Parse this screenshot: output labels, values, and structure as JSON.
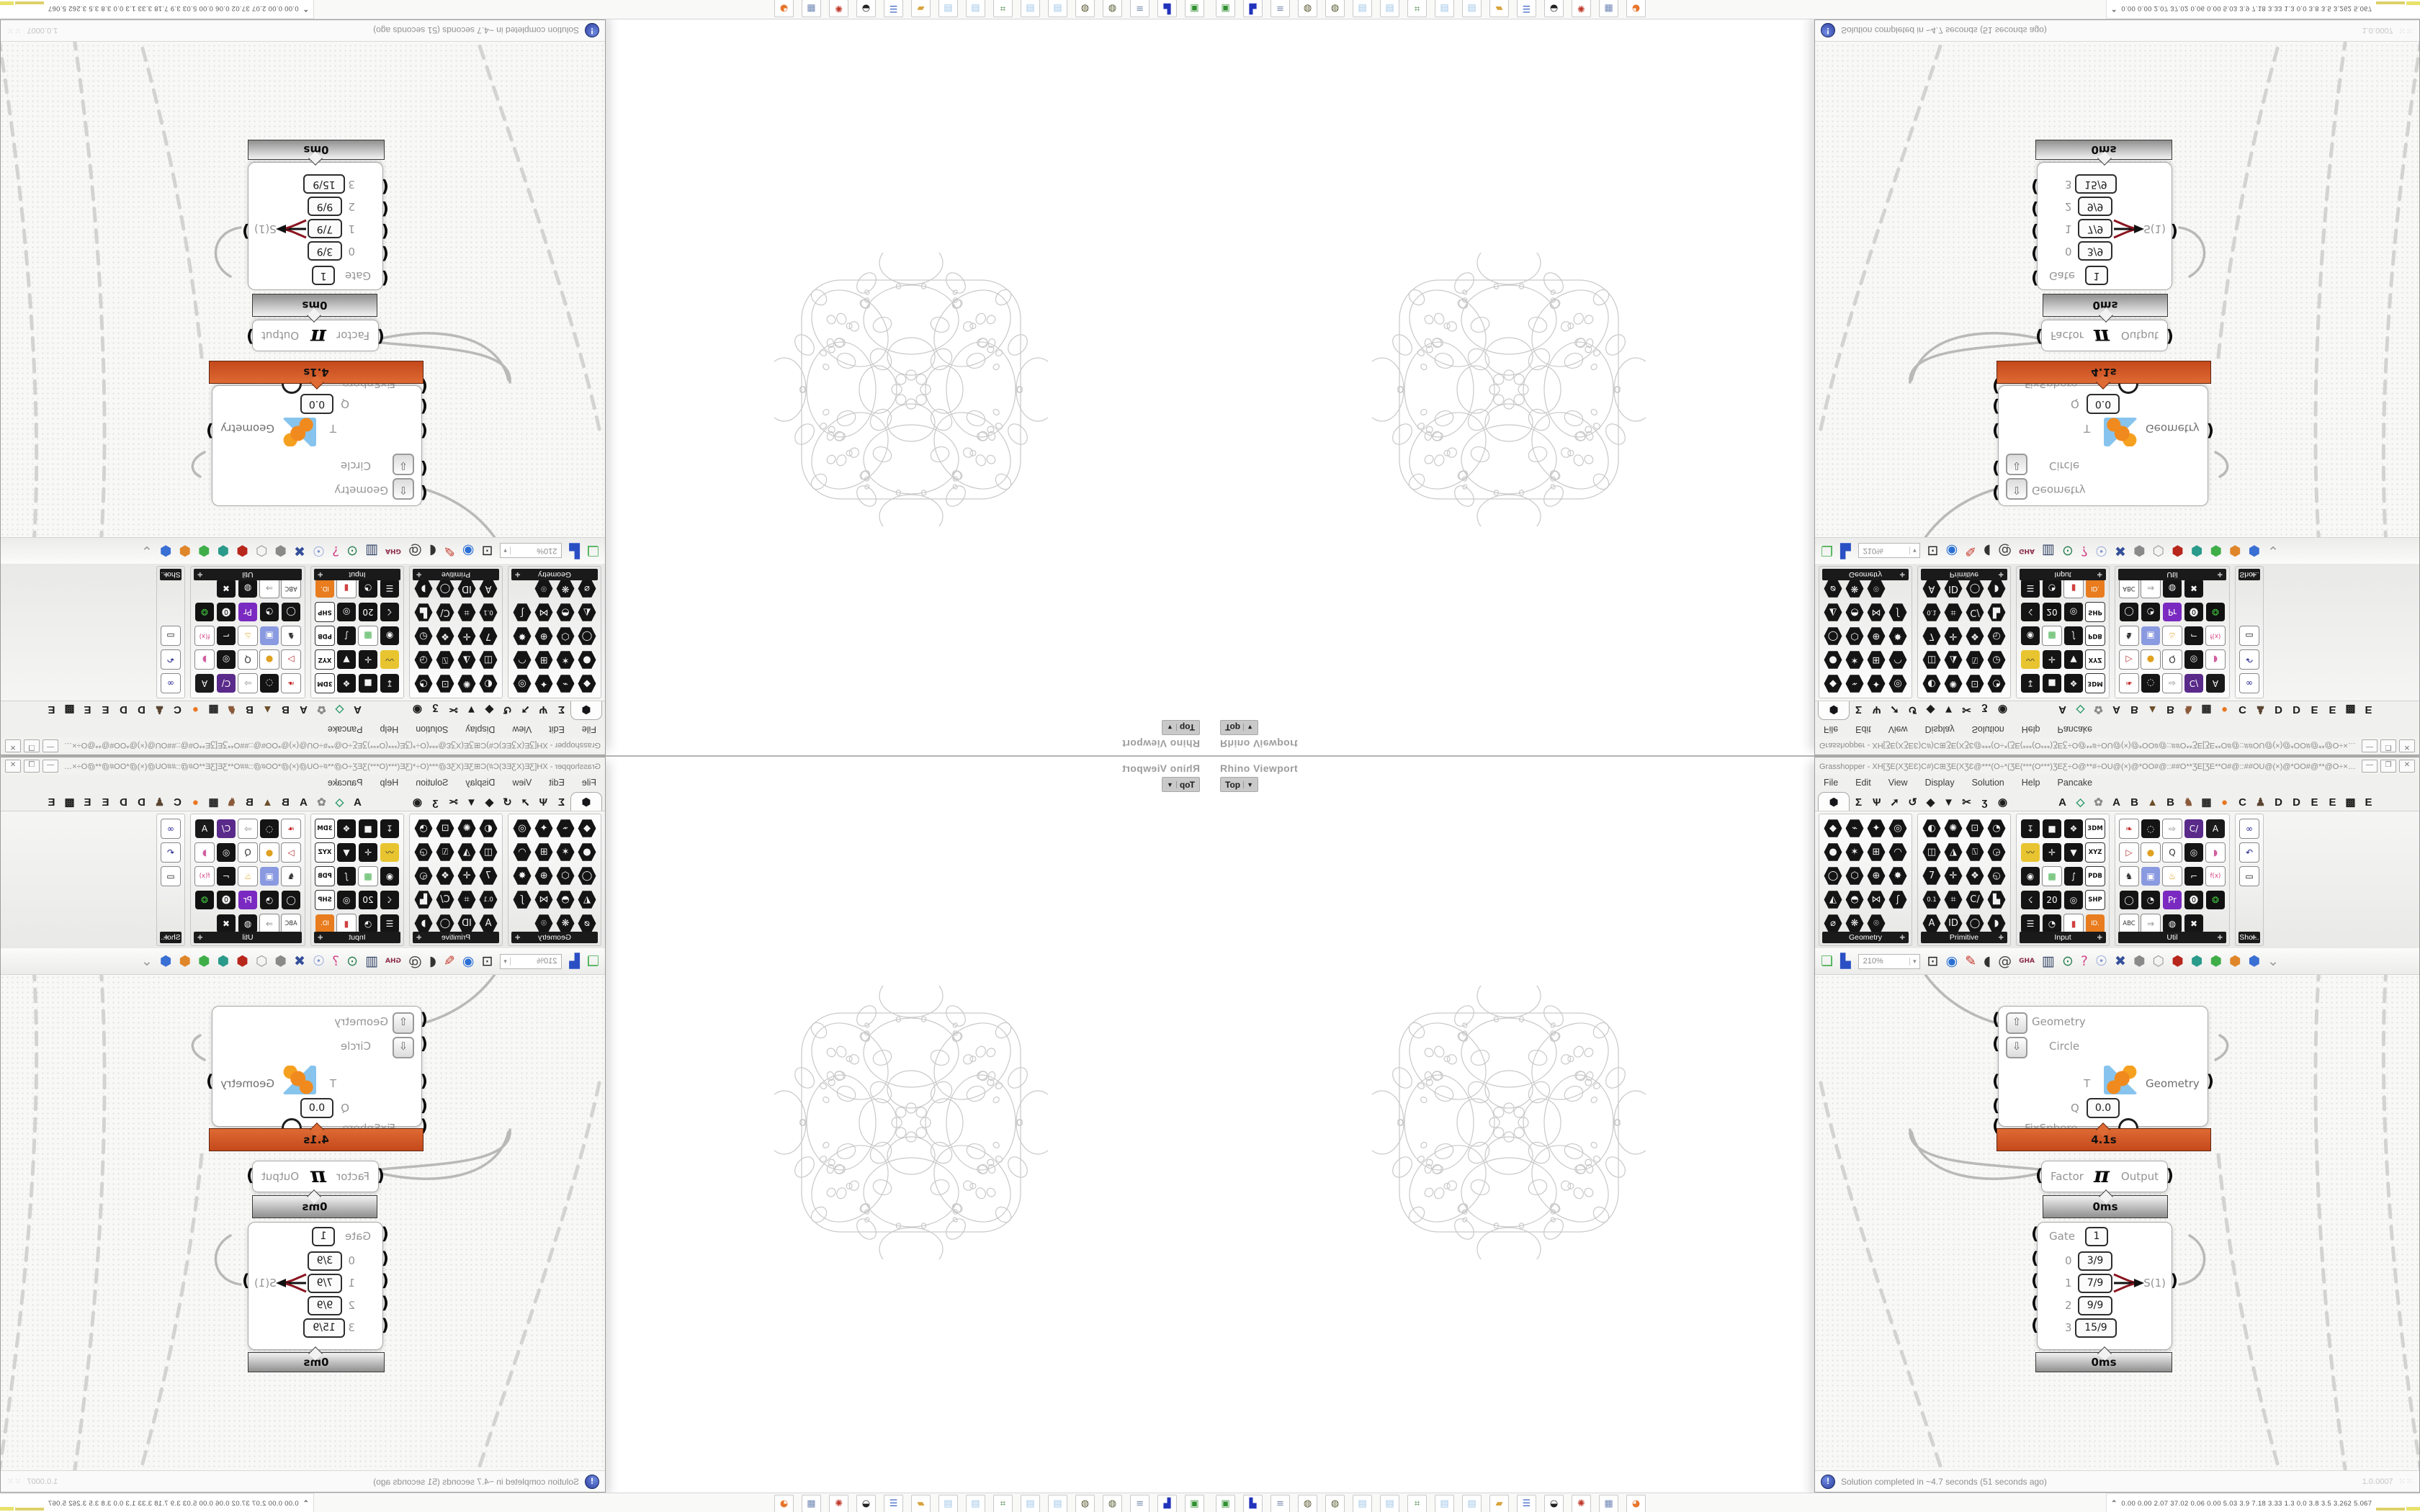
{
  "window": {
    "title": "Grasshopper - XH[ƷE(XƷEƐ)C#)C⊞ƷE(XƷƐ@***(O÷*(ƷE(***(O***)ƷEƸ÷O@**#÷OU@(×)@*OO#@::##O**ƷE[ƷE**O#@::##OU@(×)@*OO#@**@O÷×ƷƐ(**O**...",
    "buttons": [
      {
        "name": "minimize-button",
        "glyph": "—"
      },
      {
        "name": "maximize-button",
        "glyph": "❐"
      },
      {
        "name": "close-button",
        "glyph": "✕"
      }
    ]
  },
  "menu": {
    "items": [
      "File",
      "Edit",
      "View",
      "Display",
      "Solution",
      "Help",
      "Pancake"
    ]
  },
  "tabs": {
    "selected_glyph": "⬢",
    "main": [
      "Σ",
      "Ѱ",
      "➚",
      "↺",
      "◆",
      "▼",
      "✂",
      "ʒ",
      "◉"
    ],
    "plugins": [
      [
        "A",
        "#1d1d1d"
      ],
      [
        "◇",
        "#2a9a6a"
      ],
      [
        "✿",
        "#8a8a8a"
      ],
      [
        "A",
        "#1d1d1d"
      ],
      [
        "B",
        "#1d1d1d"
      ],
      [
        "▲",
        "#6b4f2a"
      ],
      [
        "B",
        "#1d1d1d"
      ],
      [
        "♞",
        "#8a5a3a"
      ],
      [
        "▦",
        "#1d1d1d"
      ],
      [
        "●",
        "#e87722"
      ],
      [
        "C",
        "#1d1d1d"
      ],
      [
        "♟",
        "#5a4632"
      ],
      [
        "D",
        "#1d1d1d"
      ],
      [
        "D",
        "#1d1d1d"
      ],
      [
        "E",
        "#1d1d1d"
      ],
      [
        "E",
        "#1d1d1d"
      ],
      [
        "▩",
        "#1d1d1d"
      ],
      [
        "E",
        "#1d1d1d"
      ]
    ]
  },
  "ribbon": {
    "panels": [
      {
        "label": "Geometry",
        "shape": "hex",
        "cols": 4,
        "cells": [
          "◆",
          "⌁",
          "✦",
          "◎",
          "●",
          "✶",
          "⊞",
          "◠",
          "◯",
          "⬡",
          "⊕",
          "✸",
          "◭",
          "◓",
          "⋈",
          "ʃ",
          "⌀",
          "❋",
          "⌾",
          ""
        ]
      },
      {
        "label": "Primitive",
        "shape": "hex",
        "cols": 4,
        "cells": [
          "◐",
          "✺",
          "⊡",
          "◔",
          "◫",
          "◮",
          "⍂",
          "◶",
          "7",
          "✛",
          "❖",
          "◵",
          "0.1",
          "⌗",
          "C/",
          "▙",
          "A",
          "ID",
          "◯",
          "◗"
        ]
      },
      {
        "label": "Input",
        "shape": "sq",
        "cols": 4,
        "cells": [
          "↧",
          "■",
          "❖",
          [
            "3DM",
            "chip"
          ],
          [
            "〰",
            "#e8c530",
            "#333"
          ],
          "✛",
          "▼",
          [
            "XYZ",
            "chip"
          ],
          "◉",
          [
            "▩",
            "#ffffff",
            "#3fae49"
          ],
          "∫",
          [
            "PDB",
            "chip"
          ],
          "☇",
          [
            "20",
            "#111",
            "#fff"
          ],
          "◎",
          [
            "SHP",
            "chip"
          ],
          "☰",
          "◔",
          [
            "▮",
            "#ffffff",
            "#d04040"
          ],
          [
            "ID.",
            "#e87c1e",
            "#fff"
          ]
        ]
      },
      {
        "label": "Util",
        "shape": "sq",
        "cols": 5,
        "cells": [
          [
            "❧",
            "#ffffff",
            "#c42a2a"
          ],
          "◌",
          [
            "⇨",
            "#ffffff",
            "#8a8a8a"
          ],
          [
            "C/",
            "#5a2a8a",
            "#fff"
          ],
          [
            "A",
            "#1a1a1a",
            "#fff"
          ],
          [
            "▷",
            "#ffffff",
            "#b03030"
          ],
          [
            "●",
            "#ffffff",
            "#e0a020"
          ],
          [
            "Q",
            "#ffffff",
            "#333"
          ],
          "◎",
          [
            "◗",
            "#ffffff",
            "#d060a0"
          ],
          [
            "♞",
            "#ffffff",
            "#333"
          ],
          [
            "▣",
            "#8a9ae0",
            "#fff"
          ],
          [
            "♨",
            "#ffffff",
            "#e0a020"
          ],
          "⌐",
          [
            "f(x)",
            "#ffffff",
            "#d04080"
          ],
          "◯",
          "◔",
          [
            "Pr",
            "#7a2ac0",
            "#fff"
          ],
          "⓿",
          [
            "❂",
            "#111111",
            "#40c040"
          ],
          [
            "ABC",
            "#ffffff",
            "#333"
          ],
          [
            "⇒",
            "#ffffff",
            "#888"
          ],
          "◍",
          "✖",
          ""
        ]
      },
      {
        "label": "Sho...",
        "shape": "sq",
        "cols": 1,
        "cells": [
          [
            "∞",
            "#ffffff",
            "#1a1a8a"
          ],
          [
            "↶",
            "#ffffff",
            "#1a1a8a"
          ],
          [
            "▭",
            "#ffffff",
            "#1a1a1a"
          ]
        ]
      }
    ]
  },
  "toolbar": {
    "zoom": "210%",
    "zoom_caret": "▾",
    "icons": [
      {
        "name": "zoom-extents-icon",
        "g": "⊡",
        "c": "#222222"
      },
      {
        "name": "preview-eye-icon",
        "g": "◉",
        "c": "#2a6fd4"
      },
      {
        "name": "sketch-pen-icon",
        "g": "✎",
        "c": "#c43a2a"
      },
      {
        "name": "boot-icon",
        "g": "◖",
        "c": "#333333"
      },
      {
        "name": "at-icon",
        "g": "@",
        "c": "#444444"
      },
      {
        "name": "gha-badge-icon",
        "g": "GHA",
        "c": "#8a2a4a",
        "small": true
      },
      {
        "name": "browser-icon",
        "g": "▥",
        "c": "#334466"
      },
      {
        "name": "magnifier-dollar-icon",
        "g": "⊙",
        "c": "#2a7f4f"
      },
      {
        "name": "help-box-icon",
        "g": "?",
        "c": "#d44a8a"
      },
      {
        "name": "lightbulb-icon",
        "g": "☉",
        "c": "#7a8fd0"
      },
      {
        "name": "crossed-wires-icon",
        "g": "✖",
        "c": "#334f9a"
      },
      {
        "name": "gem-gray-icon",
        "g": "⬢",
        "c": "#8a8a8a"
      },
      {
        "name": "gem-white-icon",
        "g": "⬡",
        "c": "#9a9a9a"
      },
      {
        "name": "gem-red-icon",
        "g": "⬢",
        "c": "#b8271c"
      },
      {
        "name": "gem-teal-icon",
        "g": "⬢",
        "c": "#2a9a8a"
      },
      {
        "name": "gem-green-icon",
        "g": "⬢",
        "c": "#3fae49"
      },
      {
        "name": "gem-orange-icon",
        "g": "⬢",
        "c": "#e0862a"
      },
      {
        "name": "gem-blue-icon",
        "g": "⬢",
        "c": "#3a6fd4"
      },
      {
        "name": "toolbar-grip-icon",
        "g": "⌄",
        "c": "#999999"
      }
    ],
    "new_file_glyph": "❏",
    "new_file_color": "#3fae49",
    "save_glyph": "▙",
    "save_color": "#2a4fc4"
  },
  "canvas": {
    "fixsphere": {
      "in_labels": [
        "Geometry",
        "Circle",
        "T",
        "Q",
        "FixSphere"
      ],
      "out_label": "Geometry",
      "q_value": "0.0",
      "runtime": "4.1s",
      "up_glyph": "⇧",
      "down_glyph": "⇩"
    },
    "pi": {
      "left": "Factor",
      "symbol": "π",
      "right": "Output",
      "time": "0ms"
    },
    "gate": {
      "label": "Gate",
      "value": "1",
      "rows": [
        [
          "0",
          "3/9"
        ],
        [
          "1",
          "7/9"
        ],
        [
          "2",
          "9/9"
        ],
        [
          "3",
          "15/9"
        ]
      ],
      "out": "S(1)",
      "time": "0ms"
    }
  },
  "status": {
    "badge": "!",
    "text": "Solution completed in ~4.7 seconds (51 seconds ago)",
    "version": "1.0.0007"
  },
  "viewport": {
    "label": "Rhino Viewport",
    "view": "Top",
    "caret": "▼"
  },
  "dock": {
    "tiles": [
      {
        "name": "monitor-green-icon",
        "g": "▣",
        "c": "#2f8f2f"
      },
      {
        "name": "floppy-64-icon",
        "g": "▙",
        "c": "#2233bb"
      },
      {
        "name": "printer-scroll-icon",
        "g": "≡",
        "c": "#7a8fb0"
      },
      {
        "name": "globe-icon",
        "g": "◍",
        "c": "#5a5a33"
      },
      {
        "name": "globe-icon",
        "g": "◍",
        "c": "#5a5a33"
      },
      {
        "name": "notepad-icon",
        "g": "▤",
        "c": "#9fc6e8"
      },
      {
        "name": "notepad-icon",
        "g": "▤",
        "c": "#9fc6e8"
      },
      {
        "name": "workstation-icon",
        "g": "⌗",
        "c": "#3f7f3f"
      },
      {
        "name": "notepad-icon",
        "g": "▤",
        "c": "#9fc6e8"
      },
      {
        "name": "notepad-icon",
        "g": "▤",
        "c": "#9fc6e8"
      },
      {
        "name": "folder-icon",
        "g": "▰",
        "c": "#d7a33a"
      },
      {
        "name": "terminal-blue-icon",
        "g": "☰",
        "c": "#3b63c4"
      },
      {
        "name": "swirl-bw-icon",
        "g": "◒",
        "c": "#222222"
      },
      {
        "name": "gear-red-icon",
        "g": "✺",
        "c": "#c0392b"
      },
      {
        "name": "calculator-icon",
        "g": "▦",
        "c": "#6f87b5"
      },
      {
        "name": "firefox-icon",
        "g": "◕",
        "c": "#e8762d"
      }
    ]
  },
  "metrics": {
    "chevron": "⌃",
    "values": "0.00 0.00 2.07 37.02 0.06 0.00 5.03 3.9 7.18 3.33 1.3 0.0 3.8 3.5 3.262 5.067",
    "bars": [
      [
        "#ddd06a",
        4,
        40
      ],
      [
        "#e8e26a",
        5,
        24
      ],
      [
        "#a8762a",
        12,
        34
      ],
      [
        "#2b4f9a",
        13,
        36
      ],
      [
        "#a8622a",
        14,
        44
      ],
      [
        "#56b056",
        3,
        28
      ],
      [
        "#c03a2e",
        8,
        34
      ]
    ]
  },
  "fractal": {
    "stroke": "#c9c9c9"
  }
}
